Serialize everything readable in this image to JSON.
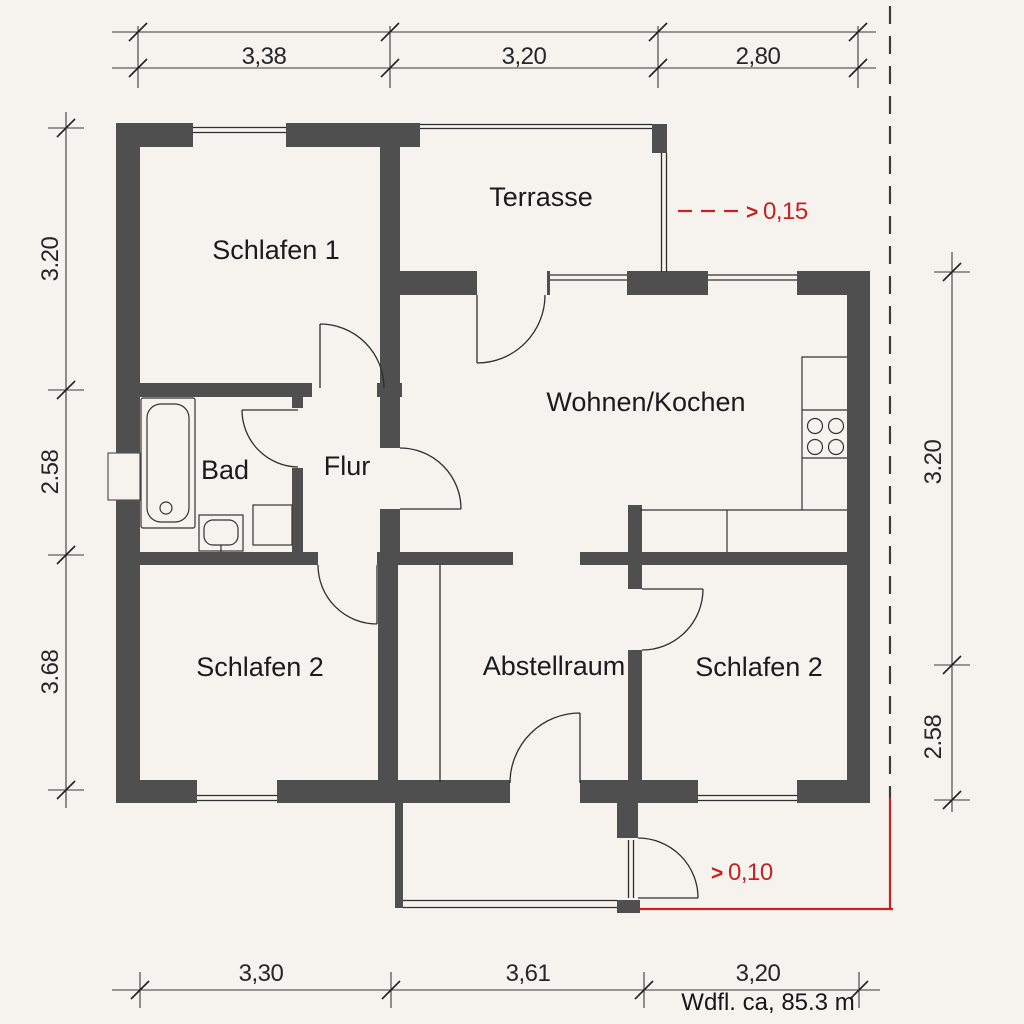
{
  "plan": {
    "type": "floor-plan",
    "rooms": [
      {
        "id": "schlafen1",
        "label": "Schlafen 1"
      },
      {
        "id": "terrasse",
        "label": "Terrasse"
      },
      {
        "id": "wohnen-kochen",
        "label": "Wohnen/Kochen"
      },
      {
        "id": "bad",
        "label": "Bad"
      },
      {
        "id": "flur",
        "label": "Flur"
      },
      {
        "id": "schlafen2-left",
        "label": "Schlafen 2"
      },
      {
        "id": "abstellraum",
        "label": "Abstellraum"
      },
      {
        "id": "schlafen2-right",
        "label": "Schlafen 2"
      }
    ],
    "dimensions": {
      "top": [
        "3,38",
        "3,20",
        "2,80"
      ],
      "left": [
        "3.20",
        "2.58",
        "3.68"
      ],
      "right": [
        "3.20",
        "2.58"
      ],
      "bottom": [
        "3,30",
        "3,61",
        "3,20"
      ]
    },
    "annotations": {
      "terrace_offset_arrow": ">",
      "terrace_offset": "0,15",
      "entrance_offset_arrow": ">",
      "entrance_offset": "0,10",
      "area_note": "Wdfl. ca, 85.3 m"
    },
    "colors": {
      "wall": "#4f4f4f",
      "line": "#2e2e2e",
      "annotation_red": "#c22323",
      "background": "#f6f3ee"
    }
  }
}
